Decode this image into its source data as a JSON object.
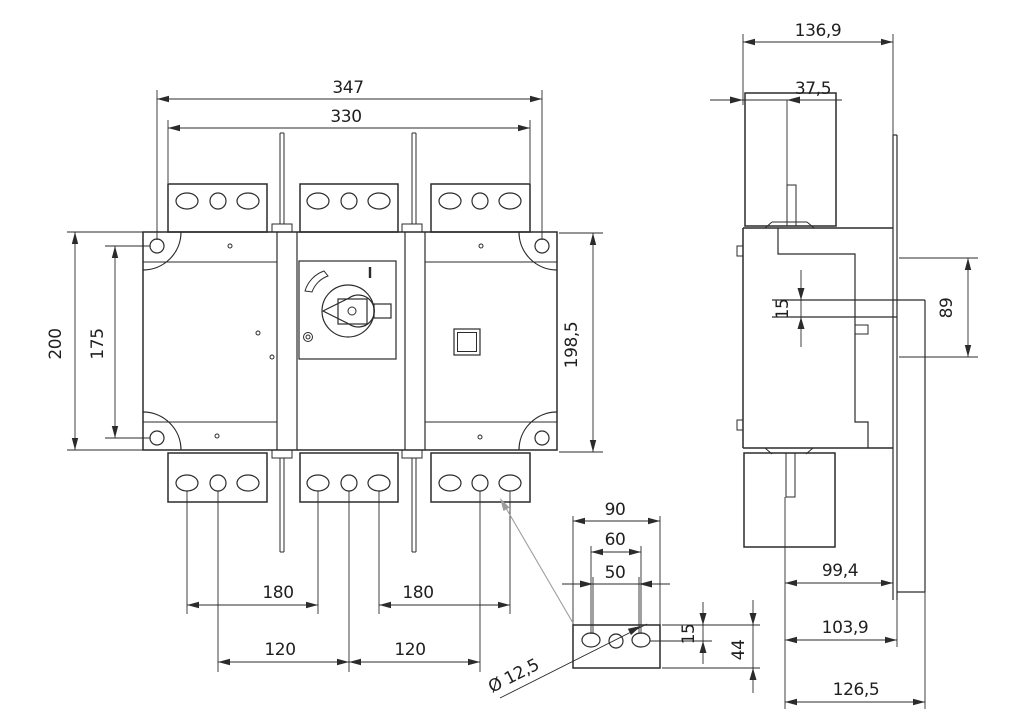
{
  "drawing": {
    "type": "technical-dimension-drawing",
    "line_color": "#2b2b2b",
    "reference_line_color": "#9c9c9c",
    "background": "#ffffff",
    "front_view": {
      "dims": {
        "overall_width": "347",
        "terminal_span": "330",
        "height": "200",
        "mount_hole_pitch": "175",
        "height_right": "198,5",
        "hole_span_left": "180",
        "hole_span_right": "180",
        "pole_pitch_left": "120",
        "pole_pitch_right": "120"
      }
    },
    "side_view": {
      "dims": {
        "depth": "136,9",
        "shaft_offset": "37,5",
        "shaft_size": "15",
        "handle_plate": "89",
        "depth_a": "99,4",
        "depth_b": "103,9",
        "depth_c": "126,5"
      }
    },
    "detail_view": {
      "dims": {
        "width": "90",
        "pitch_outer": "60",
        "pitch_inner": "50",
        "edge_offset": "15",
        "height": "44",
        "hole_dia": "Ø 12,5"
      }
    }
  }
}
